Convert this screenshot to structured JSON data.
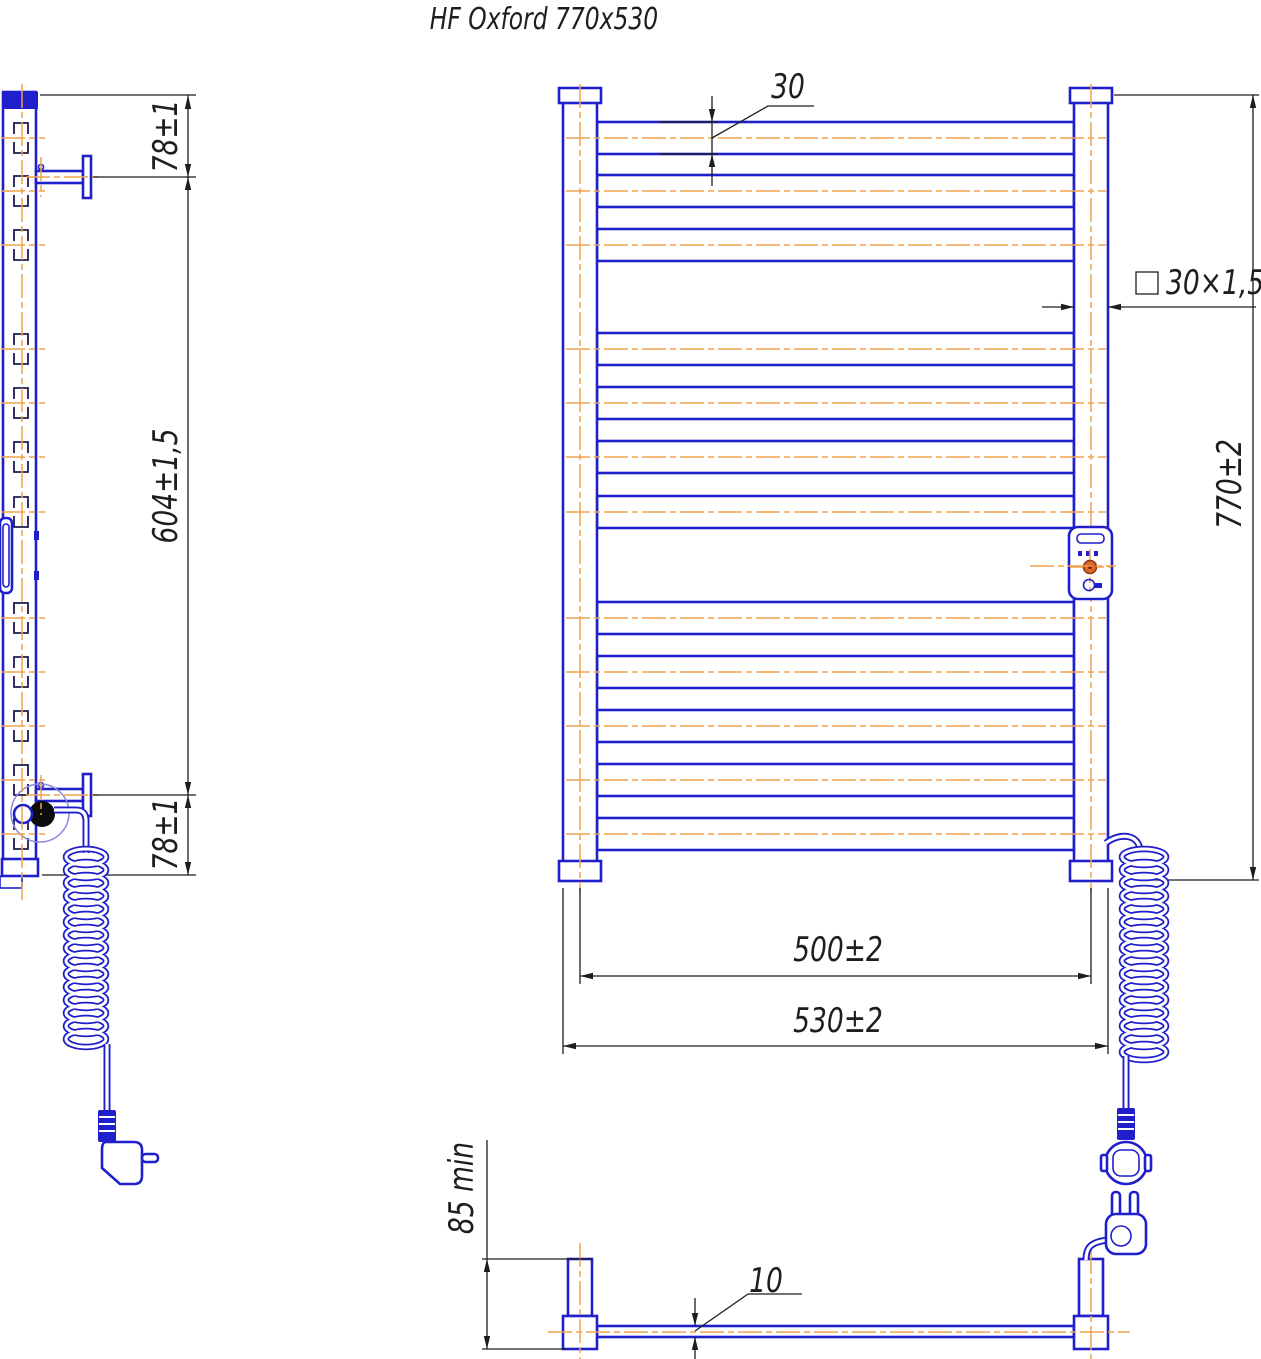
{
  "title": "HF Oxford 770x530",
  "labels": {
    "side_top": "78±1",
    "side_mid": "604±1,5",
    "side_bottom": "78±1",
    "rail_height": "30",
    "tube_spec": "30×1,5",
    "overall_height": "770±2",
    "axis_width": "500±2",
    "overall_width": "530±2",
    "wall_min": "85 min",
    "rail_depth": "10"
  },
  "colors": {
    "line_blue": "#1f1fcb",
    "centerline_orange": "#efa34f",
    "dimension_black": "#1e1e1e",
    "section_navy": "#1c1c50",
    "knob_orange": "#d96a2a",
    "element_black": "#0c0c0c"
  }
}
